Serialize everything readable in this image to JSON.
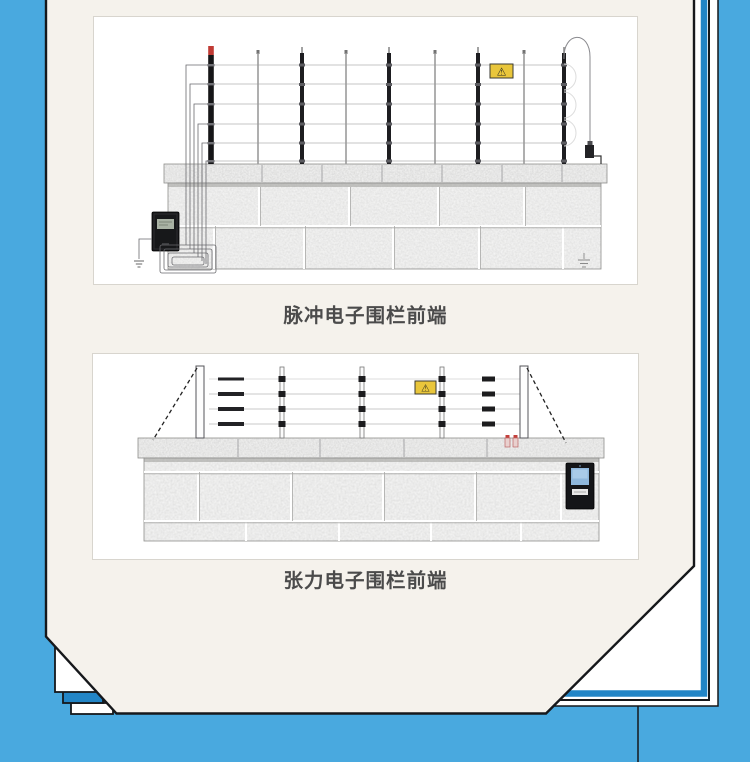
{
  "document": {
    "background_color": "#49A9DF",
    "paper_color": "#F5F2EC",
    "accent_color": "#2285C6",
    "outline_color": "#16181B",
    "figures": [
      {
        "id": "pulse",
        "caption": "脉冲电子围栏前端",
        "warning_symbol": "⚠"
      },
      {
        "id": "tension",
        "caption": "张力电子围栏前端",
        "warning_symbol": "⚠"
      }
    ]
  }
}
